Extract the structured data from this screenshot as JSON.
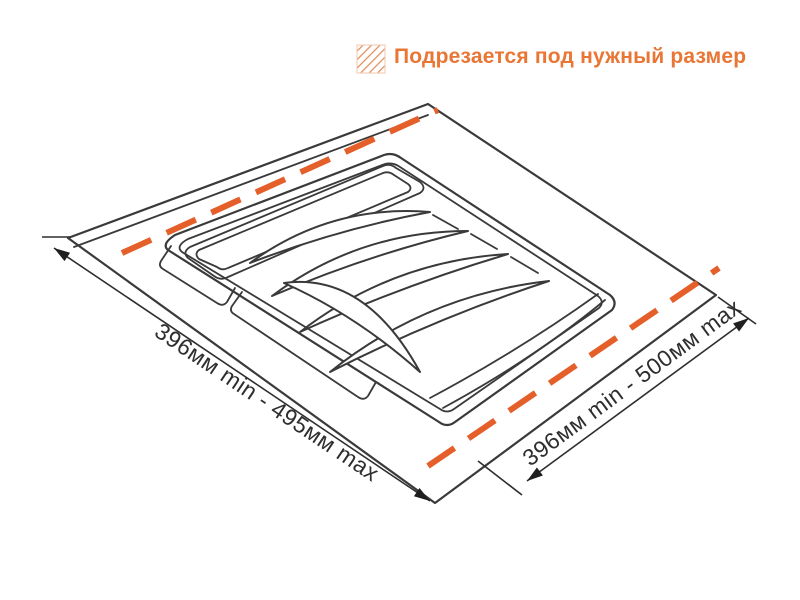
{
  "header": {
    "icon": "hatch-square-icon",
    "label": "Подрезается под нужный размер"
  },
  "diagram": {
    "type": "technical-drawing",
    "subject": "cutlery-tray-insert-perspective-view",
    "trim_lines": [
      "top-left-edge",
      "bottom-right-edge"
    ],
    "dimensions": {
      "left_label": "396мм min - 495мм max",
      "right_label": "396мм min - 500мм max"
    },
    "colors": {
      "accent_orange": "#e45f2a",
      "header_orange": "#e97634",
      "line": "#3a3a3a",
      "background": "#ffffff"
    }
  }
}
